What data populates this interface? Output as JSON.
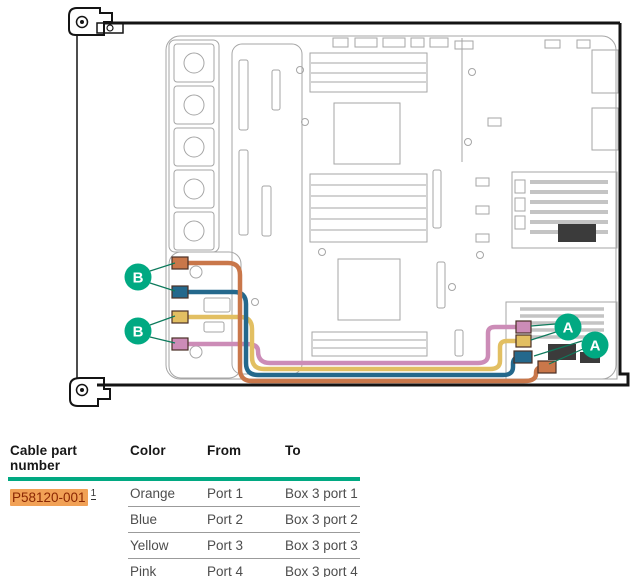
{
  "diagram": {
    "callout_a": "A",
    "callout_b": "B",
    "colors": {
      "orange": "#C9774A",
      "blue": "#24688C",
      "yellow": "#E2BF62",
      "pink": "#CC8CB7",
      "teal": "#01A982"
    }
  },
  "table": {
    "headers": [
      "Cable part number",
      "Color",
      "From",
      "To"
    ],
    "part_number": "P58120-001",
    "footnote": "1",
    "rows": [
      {
        "color": "Orange",
        "from": "Port 1",
        "to": "Box 3 port 1"
      },
      {
        "color": "Blue",
        "from": "Port 2",
        "to": "Box 3 port 2"
      },
      {
        "color": "Yellow",
        "from": "Port 3",
        "to": "Box 3 port 3"
      },
      {
        "color": "Pink",
        "from": "Port 4",
        "to": "Box 3 port 4"
      }
    ]
  }
}
